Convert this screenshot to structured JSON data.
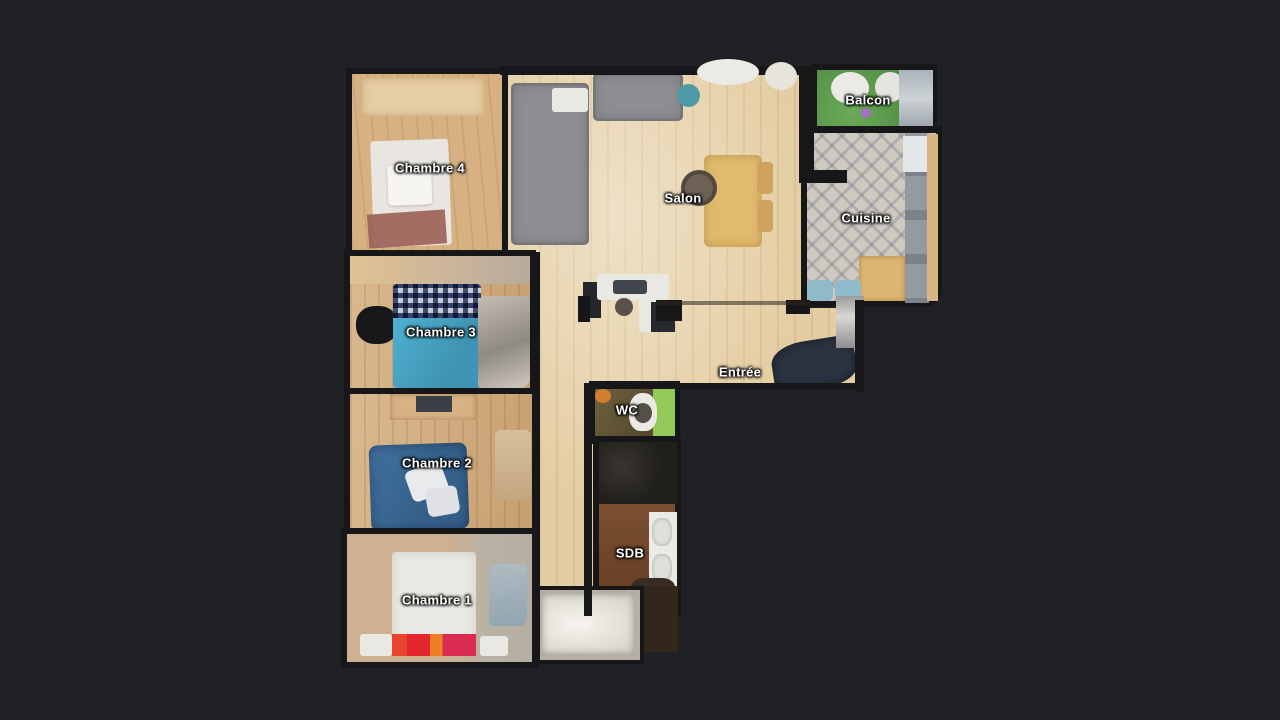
{
  "scene": {
    "type": "3d-dollhouse-floorplan-top-view",
    "background": "#202124"
  },
  "floorplan": {
    "rooms": [
      {
        "id": "chambre-4",
        "label": "Chambre 4",
        "floor": "wood"
      },
      {
        "id": "salon",
        "label": "Salon",
        "floor": "light-wood"
      },
      {
        "id": "balcon",
        "label": "Balcon",
        "floor": "green-turf"
      },
      {
        "id": "cuisine",
        "label": "Cuisine",
        "floor": "patterned-tile"
      },
      {
        "id": "chambre-3",
        "label": "Chambre 3",
        "floor": "wood"
      },
      {
        "id": "chambre-2",
        "label": "Chambre 2",
        "floor": "wood"
      },
      {
        "id": "entree",
        "label": "Entrée",
        "floor": "light-wood"
      },
      {
        "id": "wc",
        "label": "WC",
        "floor": "dark-olive-tile"
      },
      {
        "id": "sdb",
        "label": "SDB",
        "floor": "brown-tile"
      },
      {
        "id": "chambre-1",
        "label": "Chambre 1",
        "floor": "wood-and-grey"
      }
    ],
    "label_style": {
      "color": "#ffffff",
      "outline": "#1a1a1a"
    },
    "palette": {
      "background": "#202124",
      "wall": "#17171a",
      "wood_light": "#e4cda2",
      "wood_mid": "#d3a977",
      "sofa_grey": "#8e8e92",
      "bed_teal": "#45a3c2",
      "bed_navy": "#3b6a96",
      "bed_white": "#eae8e3",
      "accent_red": "#e2262f",
      "balcony_green": "#58984b",
      "kitchen_tile": "#cfcabf",
      "bathtub_white": "#f0eee8"
    }
  }
}
